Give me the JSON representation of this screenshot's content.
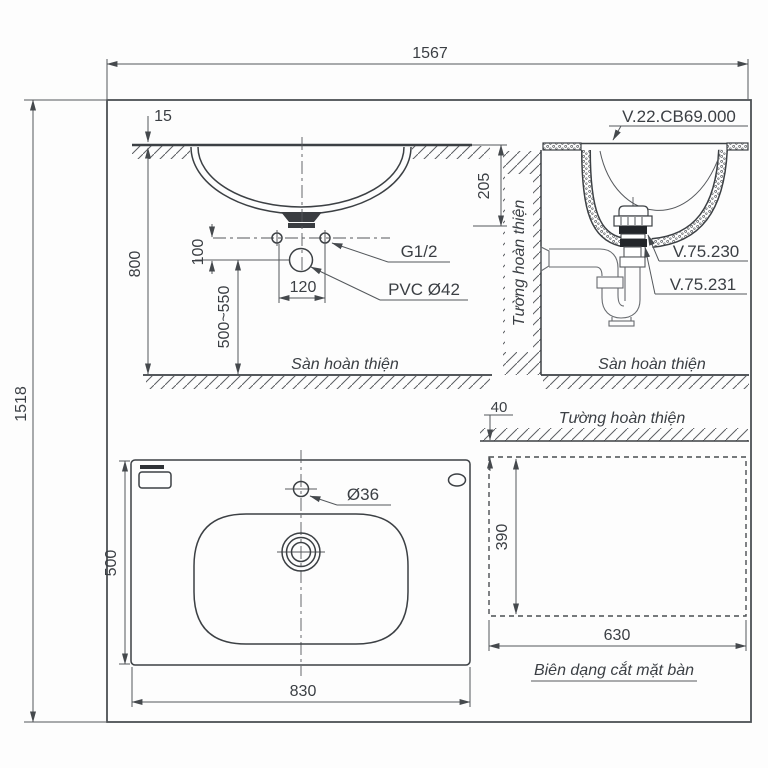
{
  "overall": {
    "width": "1567",
    "height": "1518"
  },
  "side_view": {
    "counter_thickness": "15",
    "counter_height": "800",
    "hole_offset": "100",
    "hole_spacing": "120",
    "trap_height_range": "500~550",
    "supply_label": "G1/2",
    "drain_label": "PVC Ø42",
    "floor_label": "Sàn hoàn thiện"
  },
  "section_view": {
    "basin_depth": "205",
    "basin_code": "V.22.CB69.000",
    "drain_code": "V.75.230",
    "trap_code": "V.75.231",
    "wall_label": "Tường hoàn thiện",
    "floor_label": "Sàn hoàn thiện"
  },
  "plan_view": {
    "depth": "500",
    "width": "830",
    "faucet_hole": "Ø36"
  },
  "cutout_view": {
    "wall_gap": "40",
    "cut_depth": "390",
    "cut_width": "630",
    "wall_label": "Tường hoàn thiện",
    "caption": "Biên dạng cắt mặt bàn"
  }
}
